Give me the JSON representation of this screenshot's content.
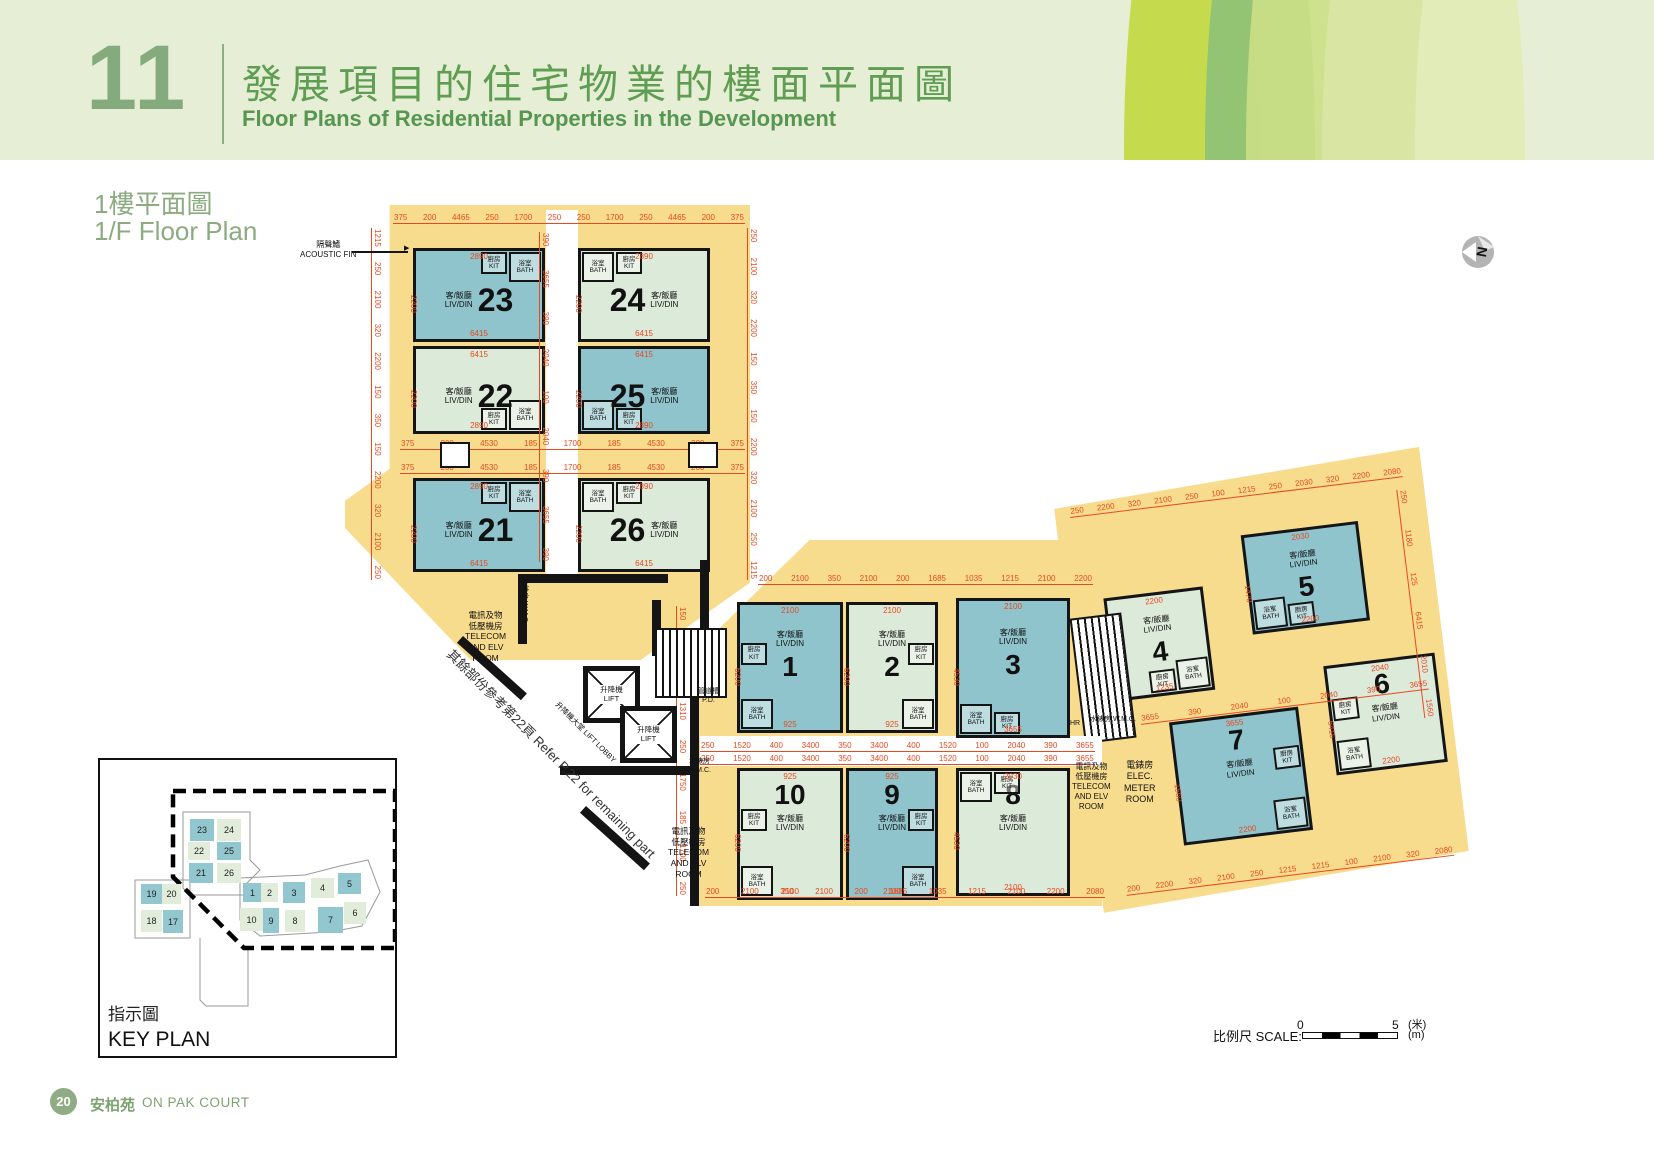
{
  "header": {
    "section_number": "11",
    "title_zh": "發展項目的住宅物業的樓面平面圖",
    "title_en": "Floor Plans of Residential Properties in the Development"
  },
  "plan_title": {
    "zh": "1樓平面圖",
    "en": "1/F Floor Plan"
  },
  "north_label": "N",
  "colors": {
    "yellow": "#f8dc8d",
    "teal": "#8fc4cc",
    "pale": "#dcead9",
    "dim_red": "#e8491f",
    "green_text": "#5f9d53",
    "wall": "#141414"
  },
  "rooms": {
    "liv_zh": "客/飯廳",
    "liv_en": "LIV/DIN",
    "bath_zh": "浴室",
    "bath_en": "BATH",
    "kit_zh": "廚房",
    "kit_en": "KIT"
  },
  "core": {
    "lift_zh": "升降機",
    "lift_en": "LIFT",
    "lobby": "升降機大堂 LIFT LOBBY",
    "wmc": "水錶房 W.M.C.",
    "pd": "管道槽\nP.D.",
    "hr": "HR",
    "elec_meter": "電錶房\nELEC.\nMETER\nROOM",
    "telecom": "電訊及物\n低壓機房\nTELECOM\nAND ELV\nROOM",
    "acoustic_fin": "隔聲鰭\nACOUSTIC FIN",
    "refer_note": "其餘部份參考第22頁        Refer P.22 for remaining part"
  },
  "footprints": [
    {
      "x": 345,
      "y": 205,
      "w": 405,
      "h": 455,
      "pts": "11% 0,100% 0,100% 83%,73% 100%,31% 100%,0 71%,0 65%,11% 58%"
    },
    {
      "x": 690,
      "y": 540,
      "w": 412,
      "h": 366,
      "pts": "29% 0,100% 0,100% 100%,0 100%,0 32%,29% 0"
    }
  ],
  "wing": {
    "x": 1052,
    "y": 492,
    "w": 370,
    "h": 424,
    "rot": -7,
    "clip": "0 4%,100% 0,100% 96%,0 100%"
  },
  "units": [
    {
      "n": "23",
      "x": 413,
      "y": 248,
      "w": 132,
      "h": 94,
      "f": "t",
      "order": "row-ln",
      "wet": "tr",
      "ns": 32,
      "dims": {
        "t": "2890",
        "l": "2200",
        "b": "6415"
      }
    },
    {
      "n": "24",
      "x": 578,
      "y": 248,
      "w": 132,
      "h": 94,
      "f": "p",
      "order": "row-nl",
      "wet": "tl",
      "ns": 32,
      "dims": {
        "t": "2890",
        "l": "2200",
        "b": "6415"
      }
    },
    {
      "n": "22",
      "x": 413,
      "y": 346,
      "w": 132,
      "h": 88,
      "f": "p",
      "order": "row-ln",
      "wet": "br",
      "ns": 32,
      "dims": {
        "t": "6415",
        "l": "2200",
        "b": "2890"
      }
    },
    {
      "n": "25",
      "x": 578,
      "y": 346,
      "w": 132,
      "h": 88,
      "f": "t",
      "order": "row-nl",
      "wet": "bl",
      "ns": 32,
      "dims": {
        "t": "6415",
        "l": "2200",
        "b": "2890"
      }
    },
    {
      "n": "21",
      "x": 413,
      "y": 478,
      "w": 132,
      "h": 94,
      "f": "t",
      "order": "row-ln",
      "wet": "tr",
      "ns": 32,
      "dims": {
        "t": "2890",
        "l": "2200",
        "b": "6415"
      }
    },
    {
      "n": "26",
      "x": 578,
      "y": 478,
      "w": 132,
      "h": 94,
      "f": "p",
      "order": "row-nl",
      "wet": "tl",
      "ns": 32,
      "dims": {
        "t": "2890",
        "l": "2200",
        "b": "6415"
      }
    },
    {
      "n": "1",
      "x": 737,
      "y": 602,
      "w": 106,
      "h": 131,
      "f": "t",
      "order": "col-ln",
      "wet": "l",
      "ns": 28,
      "dims": {
        "t": "2100",
        "l": "6200",
        "b": "925"
      }
    },
    {
      "n": "2",
      "x": 846,
      "y": 602,
      "w": 92,
      "h": 131,
      "f": "p",
      "order": "col-ln",
      "wet": "r",
      "ns": 28,
      "dims": {
        "t": "2100",
        "l": "6200",
        "b": "925"
      }
    },
    {
      "n": "3",
      "x": 956,
      "y": 598,
      "w": 114,
      "h": 140,
      "f": "t",
      "order": "col-ln",
      "wet": "bl",
      "ns": 28,
      "dims": {
        "t": "2100",
        "l": "4530",
        "b": "3655"
      }
    },
    {
      "n": "10",
      "x": 737,
      "y": 768,
      "w": 106,
      "h": 132,
      "f": "p",
      "order": "col-nl",
      "wet": "l",
      "ns": 28,
      "dims": {
        "t": "925",
        "l": "6200",
        "b": "2100"
      }
    },
    {
      "n": "9",
      "x": 846,
      "y": 768,
      "w": 92,
      "h": 132,
      "f": "t",
      "order": "col-nl",
      "wet": "r",
      "ns": 28,
      "dims": {
        "t": "925",
        "l": "6200",
        "b": "2100"
      }
    },
    {
      "n": "8",
      "x": 956,
      "y": 768,
      "w": 114,
      "h": 128,
      "f": "p",
      "order": "col-nl",
      "wet": "tl",
      "ns": 28,
      "dims": {
        "t": "2030",
        "l": "4530",
        "b": "2100"
      }
    },
    {
      "n": "4",
      "c": 1,
      "x": 38,
      "y": 112,
      "w": 100,
      "h": 104,
      "f": "p",
      "order": "col-ln",
      "wet": "br",
      "ns": 28,
      "dims": {
        "t": "2200",
        "l": "2890",
        "b": "1235"
      }
    },
    {
      "n": "5",
      "c": 1,
      "x": 182,
      "y": 66,
      "w": 118,
      "h": 100,
      "f": "t",
      "order": "col-ln",
      "wet": "bl",
      "ns": 28,
      "dims": {
        "t": "2030",
        "l": "1470",
        "b": "2200"
      }
    },
    {
      "n": "7",
      "c": 1,
      "x": 88,
      "y": 243,
      "w": 130,
      "h": 124,
      "f": "t",
      "order": "col-nl",
      "wet": "r",
      "ns": 28,
      "dims": {
        "t": "3655",
        "l": "1560",
        "b": "2200"
      }
    },
    {
      "n": "6",
      "c": 1,
      "x": 248,
      "y": 206,
      "w": 112,
      "h": 110,
      "f": "p",
      "order": "col-nl",
      "wet": "l",
      "ns": 28,
      "dims": {
        "t": "2040",
        "l": "6415",
        "b": "2200"
      }
    }
  ],
  "strips": [
    {
      "x": 393,
      "y": 214,
      "len": 352,
      "v": 0,
      "vals": [
        "375",
        "200",
        "4465",
        "250",
        "1700",
        "250",
        "250",
        "1700",
        "250",
        "4465",
        "200",
        "375"
      ]
    },
    {
      "x": 381,
      "y": 228,
      "len": 352,
      "v": 1,
      "vals": [
        "1215",
        "250",
        "2100",
        "320",
        "2200",
        "150",
        "350",
        "150",
        "2200",
        "320",
        "2100",
        "250"
      ]
    },
    {
      "x": 757,
      "y": 228,
      "len": 352,
      "v": 1,
      "vals": [
        "250",
        "2100",
        "320",
        "2200",
        "150",
        "350",
        "150",
        "2200",
        "320",
        "2100",
        "250",
        "1215"
      ]
    },
    {
      "x": 549,
      "y": 232,
      "len": 330,
      "v": 1,
      "vals": [
        "390",
        "3655",
        "390",
        "2040",
        "100",
        "2040",
        "390",
        "3655",
        "390"
      ]
    },
    {
      "x": 400,
      "y": 440,
      "len": 345,
      "v": 0,
      "vals": [
        "375",
        "200",
        "4530",
        "185",
        "1700",
        "185",
        "4530",
        "200",
        "375"
      ]
    },
    {
      "x": 400,
      "y": 464,
      "len": 345,
      "v": 0,
      "vals": [
        "375",
        "200",
        "4530",
        "185",
        "1700",
        "185",
        "4530",
        "200",
        "375"
      ]
    },
    {
      "x": 758,
      "y": 575,
      "len": 335,
      "v": 0,
      "vals": [
        "200",
        "2100",
        "350",
        "2100",
        "200",
        "1685",
        "1035",
        "1215",
        "2100",
        "2200"
      ]
    },
    {
      "x": 700,
      "y": 742,
      "len": 395,
      "v": 0,
      "vals": [
        "250",
        "1520",
        "400",
        "3400",
        "350",
        "3400",
        "400",
        "1520",
        "100",
        "2040",
        "390",
        "3655"
      ]
    },
    {
      "x": 700,
      "y": 755,
      "len": 395,
      "v": 0,
      "vals": [
        "250",
        "1520",
        "400",
        "3400",
        "350",
        "3400",
        "400",
        "1520",
        "100",
        "2040",
        "390",
        "3655"
      ]
    },
    {
      "x": 705,
      "y": 888,
      "len": 400,
      "v": 0,
      "vals": [
        "200",
        "2100",
        "350",
        "2100",
        "200",
        "1685",
        "1035",
        "1215",
        "2100",
        "2200",
        "2080"
      ]
    },
    {
      "x": 686,
      "y": 606,
      "len": 290,
      "v": 1,
      "vals": [
        "150",
        "930",
        "75",
        "1310",
        "250",
        "1750",
        "185",
        "1700",
        "250"
      ]
    },
    {
      "c": 1,
      "x": 15,
      "y": 18,
      "len": 335,
      "v": 0,
      "vals": [
        "250",
        "2200",
        "320",
        "2100",
        "250",
        "100",
        "1215",
        "250",
        "2030",
        "320",
        "2200",
        "2080"
      ]
    },
    {
      "c": 1,
      "x": 60,
      "y": 232,
      "len": 290,
      "v": 0,
      "vals": [
        "3655",
        "390",
        "2040",
        "100",
        "2040",
        "390",
        "3655"
      ]
    },
    {
      "c": 1,
      "x": 25,
      "y": 400,
      "len": 330,
      "v": 0,
      "vals": [
        "200",
        "2200",
        "320",
        "2100",
        "250",
        "1215",
        "1215",
        "100",
        "2100",
        "320",
        "2080"
      ]
    },
    {
      "c": 1,
      "x": 352,
      "y": 40,
      "len": 230,
      "v": 1,
      "vals": [
        "250",
        "1180",
        "125",
        "6415",
        "2010",
        "1560"
      ]
    }
  ],
  "walls": [
    {
      "x": 518,
      "y": 574,
      "w": 150,
      "h": 9
    },
    {
      "x": 518,
      "y": 574,
      "w": 9,
      "h": 70
    },
    {
      "x": 700,
      "y": 560,
      "w": 9,
      "h": 88
    },
    {
      "x": 560,
      "y": 766,
      "w": 130,
      "h": 9
    },
    {
      "x": 652,
      "y": 600,
      "w": 9,
      "h": 56
    },
    {
      "x": 690,
      "y": 648,
      "w": 9,
      "h": 258
    },
    {
      "x": 463,
      "y": 636,
      "w": 86,
      "h": 9,
      "rot": 42
    },
    {
      "x": 586,
      "y": 806,
      "w": 86,
      "h": 9,
      "rot": 42
    },
    {
      "x": 352,
      "y": 251,
      "w": 56,
      "h": 2
    }
  ],
  "wwins": [
    {
      "x": 440,
      "y": 442,
      "w": 30,
      "h": 26
    },
    {
      "x": 688,
      "y": 442,
      "w": 30,
      "h": 26
    }
  ],
  "stairs": [
    {
      "x": 655,
      "y": 628,
      "w": 72,
      "h": 70
    },
    {
      "c": 1,
      "x": 2,
      "y": 128,
      "w": 52,
      "h": 126
    }
  ],
  "lifts": [
    {
      "x": 583,
      "y": 666,
      "s": 57
    },
    {
      "x": 620,
      "y": 706,
      "s": 57
    }
  ],
  "annotations": [
    {
      "x": 300,
      "y": 240,
      "size": 8,
      "key": "acoustic_fin"
    },
    {
      "x": 404,
      "y": 245,
      "size": 7,
      "text": "▶"
    },
    {
      "x": 465,
      "y": 610,
      "size": 8.5,
      "key": "telecom"
    },
    {
      "x": 668,
      "y": 826,
      "size": 8.5,
      "key": "telecom"
    },
    {
      "x": 1072,
      "y": 762,
      "size": 8,
      "key": "telecom"
    },
    {
      "x": 1124,
      "y": 760,
      "size": 9,
      "key": "elec_meter"
    },
    {
      "x": 688,
      "y": 758,
      "size": 7,
      "text": "水錶房\nW.M.C."
    },
    {
      "x": 1090,
      "y": 716,
      "size": 7,
      "key": "wmc"
    },
    {
      "x": 1070,
      "y": 720,
      "size": 7,
      "key": "hr"
    },
    {
      "x": 698,
      "y": 688,
      "size": 7,
      "key": "pd"
    },
    {
      "x": 528,
      "y": 578,
      "size": 7,
      "rot": 90,
      "key": "wmc"
    },
    {
      "x": 560,
      "y": 700,
      "size": 7.5,
      "rot": 45,
      "key": "lobby"
    },
    {
      "x": 408,
      "y": 600,
      "size": 13,
      "rot": 45,
      "key": "refer_note",
      "w": 420,
      "color": "#333"
    }
  ],
  "keyplan": {
    "title_zh": "指示圖",
    "title_en": "KEY PLAN",
    "units": [
      {
        "n": "23",
        "x": 90,
        "y": 59,
        "w": 24,
        "h": 22,
        "f": "t"
      },
      {
        "n": "24",
        "x": 117,
        "y": 59,
        "w": 24,
        "h": 22,
        "f": "p"
      },
      {
        "n": "22",
        "x": 88,
        "y": 82,
        "w": 22,
        "h": 18,
        "f": "p"
      },
      {
        "n": "25",
        "x": 117,
        "y": 82,
        "w": 24,
        "h": 18,
        "f": "t"
      },
      {
        "n": "21",
        "x": 89,
        "y": 103,
        "w": 24,
        "h": 20,
        "f": "t"
      },
      {
        "n": "26",
        "x": 117,
        "y": 103,
        "w": 24,
        "h": 20,
        "f": "p"
      },
      {
        "n": "19",
        "x": 41,
        "y": 124,
        "w": 21,
        "h": 20,
        "f": "t"
      },
      {
        "n": "20",
        "x": 62,
        "y": 124,
        "w": 19,
        "h": 20,
        "f": "p"
      },
      {
        "n": "18",
        "x": 41,
        "y": 150,
        "w": 21,
        "h": 22,
        "f": "p"
      },
      {
        "n": "17",
        "x": 63,
        "y": 150,
        "w": 20,
        "h": 23,
        "f": "t"
      },
      {
        "n": "1",
        "x": 143,
        "y": 123,
        "w": 19,
        "h": 19,
        "f": "t"
      },
      {
        "n": "2",
        "x": 161,
        "y": 123,
        "w": 17,
        "h": 19,
        "f": "p"
      },
      {
        "n": "3",
        "x": 183,
        "y": 122,
        "w": 22,
        "h": 21,
        "f": "t"
      },
      {
        "n": "4",
        "x": 211,
        "y": 118,
        "w": 23,
        "h": 20,
        "f": "p"
      },
      {
        "n": "5",
        "x": 238,
        "y": 113,
        "w": 23,
        "h": 21,
        "f": "t"
      },
      {
        "n": "10",
        "x": 140,
        "y": 148,
        "w": 23,
        "h": 23,
        "f": "p"
      },
      {
        "n": "9",
        "x": 163,
        "y": 148,
        "w": 16,
        "h": 25,
        "f": "t"
      },
      {
        "n": "8",
        "x": 185,
        "y": 150,
        "w": 20,
        "h": 22,
        "f": "p"
      },
      {
        "n": "7",
        "x": 218,
        "y": 147,
        "w": 25,
        "h": 26,
        "f": "t"
      },
      {
        "n": "6",
        "x": 244,
        "y": 142,
        "w": 22,
        "h": 22,
        "f": "p"
      }
    ]
  },
  "scalebar": {
    "label": "比例尺 SCALE:",
    "start": "0",
    "end": "5",
    "unit_zh": "(米)",
    "unit_en": "(m)"
  },
  "footer": {
    "page_number": "20",
    "name_zh": "安柏苑",
    "name_en": "ON PAK COURT"
  }
}
